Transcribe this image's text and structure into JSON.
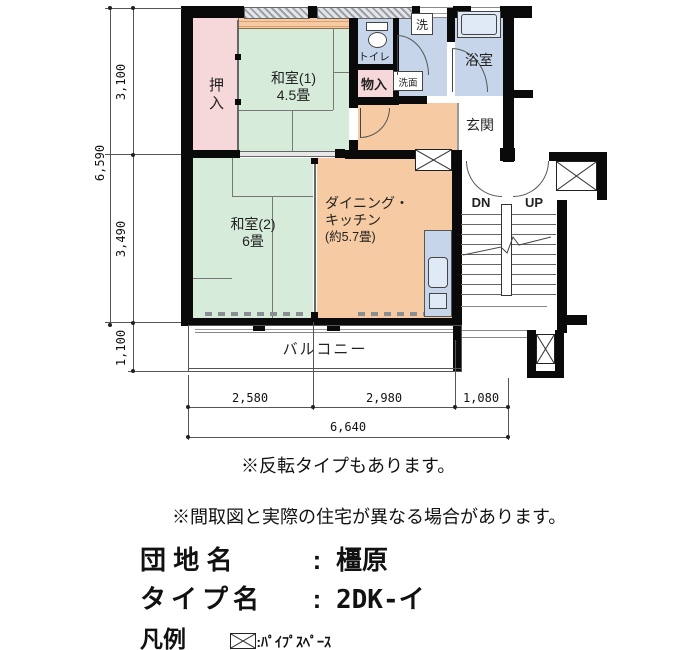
{
  "colors": {
    "tatami_green": "#d6ebd9",
    "closet_pink": "#f7d8da",
    "dk_orange": "#f6cba3",
    "wet_area_blue": "#c6d5e9",
    "fixture_light_blue": "#e0eaf6",
    "wall_black": "#0a0a0a"
  },
  "plan": {
    "rooms": {
      "oshiire": "押入",
      "washitsu1_name": "和室(1)",
      "washitsu1_size": "4.5畳",
      "washitsu2_name": "和室(2)",
      "washitsu2_size": "6畳",
      "dk_line1": "ダイニング・",
      "dk_line2": "キッチン",
      "dk_line3": "(約5.7畳)",
      "toilet": "トイレ",
      "washer": "洗",
      "vanity": "洗面",
      "storage": "物入",
      "bath": "浴室",
      "entrance": "玄関",
      "balcony": "バルコニー",
      "stairs_down": "DN",
      "stairs_up": "UP"
    },
    "dimensions": {
      "left_total": "6,590",
      "left_top": "3,100",
      "left_middle": "3,490",
      "left_bottom": "1,100",
      "bottom_seg1": "2,580",
      "bottom_seg2": "2,980",
      "bottom_seg3": "1,080",
      "bottom_total": "6,640"
    }
  },
  "notes": {
    "note1": "※反転タイプもあります。",
    "note2": "※間取図と実際の住宅が異なる場合があります。"
  },
  "info": {
    "estate_label": "団 地 名",
    "colon": ":",
    "estate_value": "橿原",
    "type_label": "タイプ名",
    "type_value": "2DK-イ"
  },
  "legend": {
    "title": "凡例",
    "pipe_space_label": ":ﾊﾟｲﾌﾟｽﾍﾟｰｽ"
  }
}
